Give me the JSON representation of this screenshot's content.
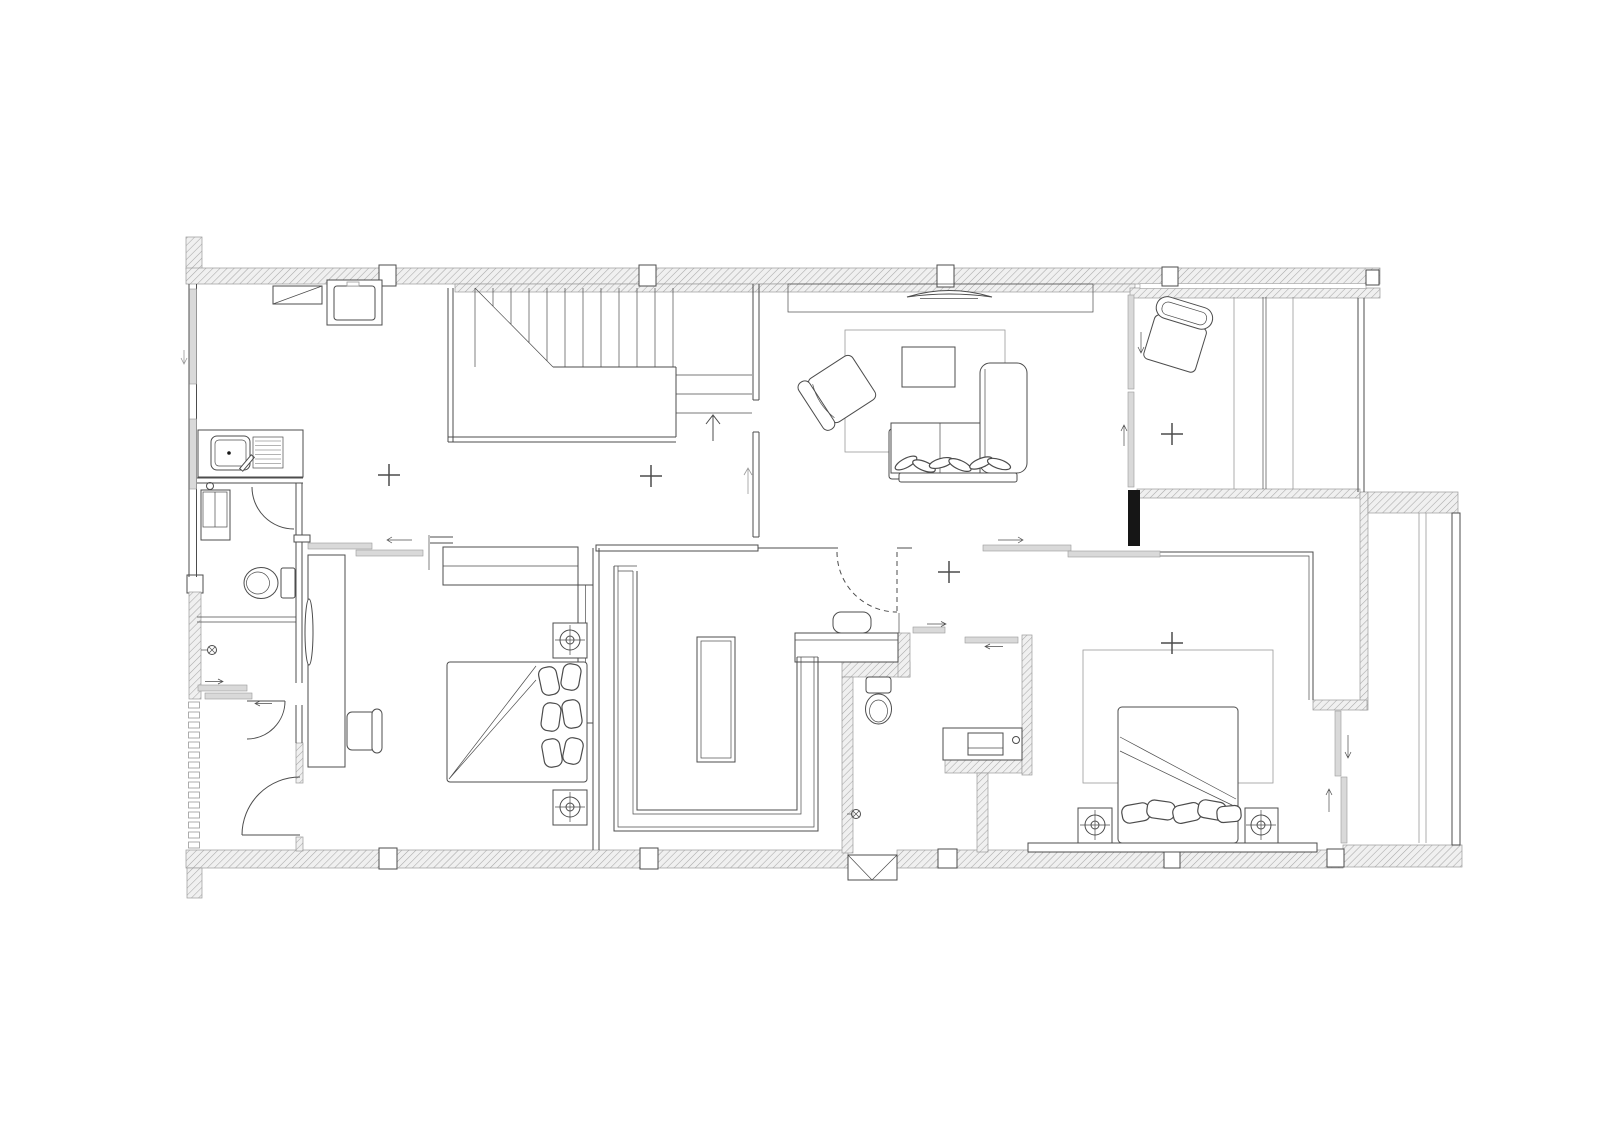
{
  "plan": {
    "type": "architectural-floor-plan",
    "storey": "residential floor with stair, living area, two bedrooms, walk-in closet, two bathrooms, utility hall and side terrace"
  },
  "colors": {
    "background": "#ffffff",
    "line": "#4c4c4c",
    "line_light": "#9a9a9a",
    "wall_hatch_line": "#a8a8a8",
    "wall_hatch_bg": "#f0f0f0",
    "column_dark": "#161616",
    "glass_fill": "#d9d9d9"
  },
  "symbols": [
    "staircase-icon",
    "up-arrow-icon",
    "washing-machine-icon",
    "shoe-cabinet-icon",
    "kitchen-sink-icon",
    "drainboard-icon",
    "tall-cabinet-icon",
    "toilet-icon",
    "shower-head-icon",
    "door-swing-icon",
    "sliding-door-icon",
    "louver-vent-icon",
    "window-icon",
    "column-icon",
    "wardrobe-icon",
    "island-dresser-icon",
    "bed-icon",
    "pillow-icon",
    "nightstand-lamp-icon",
    "desk-icon",
    "chair-icon",
    "mirror-icon",
    "sofa-icon",
    "chaise-icon",
    "armchair-icon",
    "lounge-chair-icon",
    "coffee-table-icon",
    "rug-icon",
    "tv-icon",
    "tv-console-icon",
    "vanity-basin-icon",
    "stool-icon",
    "ac-ledge-icon",
    "railing-icon",
    "center-mark-icon"
  ]
}
